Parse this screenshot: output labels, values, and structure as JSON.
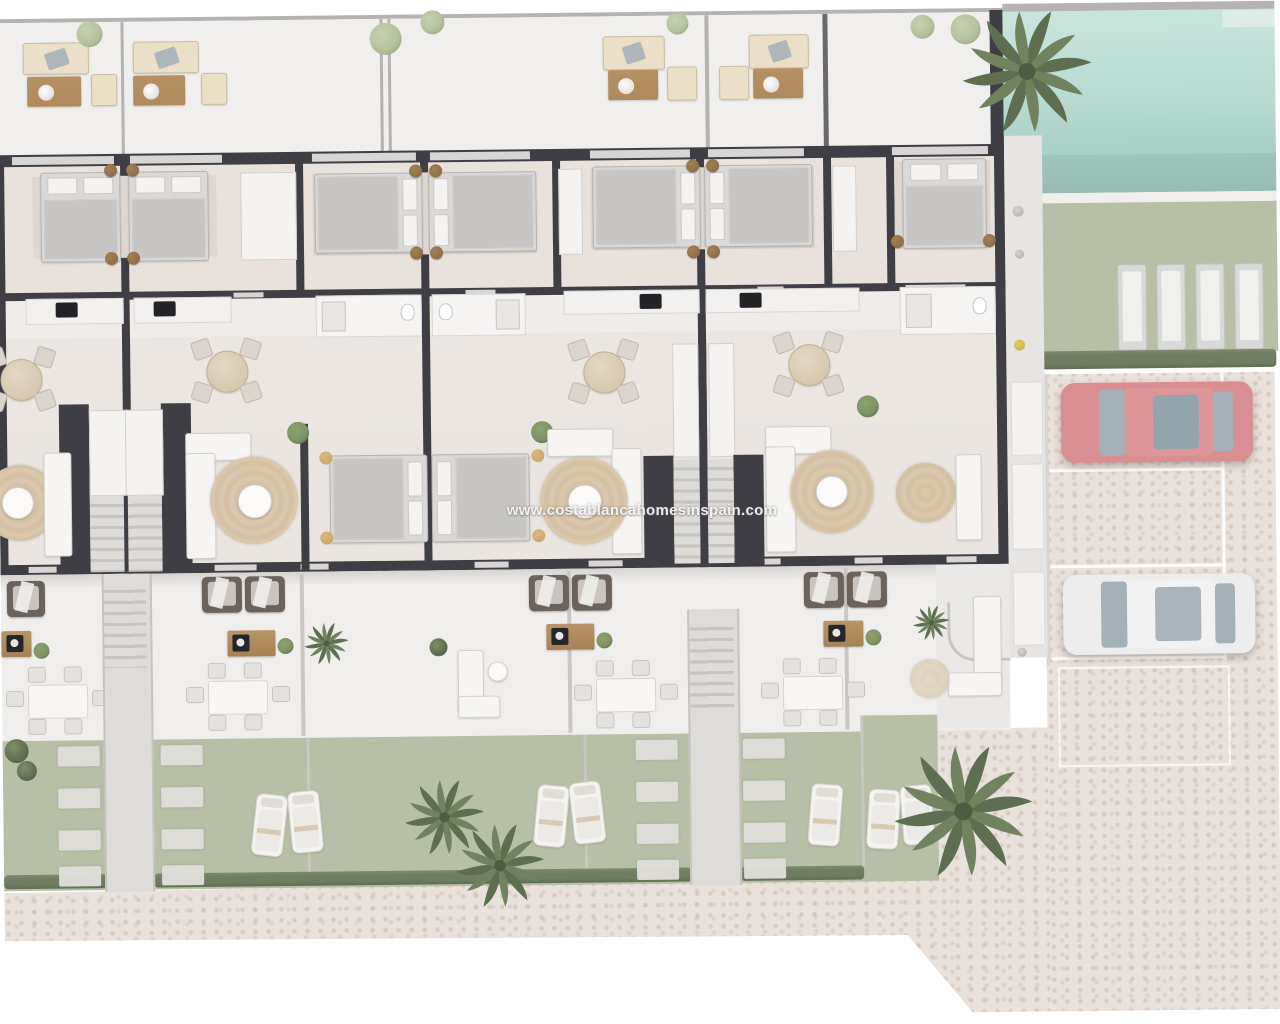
{
  "watermark": {
    "text": "www.costablancahomesinspain.com"
  },
  "scene": {
    "kind": "top-down 3D rendered floor plan of a row of townhouses",
    "visible_counts": {
      "roof_terrace_sofa_sets": 4,
      "bedrooms_with_double_beds": 7,
      "stair_cores": 2,
      "dining_sets_indoor": 4,
      "living_room_rugs": 5,
      "terrace_armchair_groups": 4,
      "outdoor_dining_sets": 4,
      "garden_sun_loungers": 7,
      "communal_sunbeds_by_pool_lawn": 4,
      "cars": 2,
      "palm_trees": 4
    },
    "cars": [
      {
        "name": "red-car",
        "color": "#dd8e90"
      },
      {
        "name": "white-car",
        "color": "#ededee"
      }
    ],
    "pool": {
      "present": true,
      "water_color": "#b9ded4"
    }
  },
  "colors": {
    "wall": "#3f3e44",
    "wallLight": "#b5b3b1",
    "win": "#d8d6d4",
    "fence": "#cac6c2",
    "floor": "#e9e3de",
    "floorBed": "#e9e1db",
    "floorKitchen": "#efece9",
    "floorDine": "#ebe6e2",
    "floorLive": "#eae5e0",
    "terraceTop": "#f0efed",
    "terrace": "#f0eeec",
    "paveLight": "#ebe9e7",
    "lawn": "#b7bfa4",
    "lawnEdge": "#6e7d5f",
    "pool": "#b9ded4",
    "poolDeep": "#9ec7bd",
    "deck": "#f0efec",
    "cobble": "#eae1da",
    "stone": "#e0deda",
    "path": "#dedcd9",
    "wood": "#b18a59",
    "cream": "#ecdfc6",
    "white": "#f6f5f3",
    "bedGray": "#dbd9d7",
    "blanket": "#c8c6c4",
    "rugTan": "#d6c2a3",
    "chairDark": "#6b625a",
    "plant": "#7d9464",
    "plantDark": "#55654a",
    "bushLight": "#b4c29b",
    "pouf": "#8a6540",
    "poufTan": "#c8a05e",
    "hob": "#232327",
    "carRed": "#dd8e90",
    "carRedRoof": "#e29598",
    "carWhite": "#ededee",
    "carWhiteRoof": "#f2f2f2",
    "glass": "#a3b1ba",
    "yellow": "#d4ae3e",
    "fixture": "#e8e7e5",
    "counter": "#f2f1ef",
    "stallLine": "#ffffff"
  }
}
